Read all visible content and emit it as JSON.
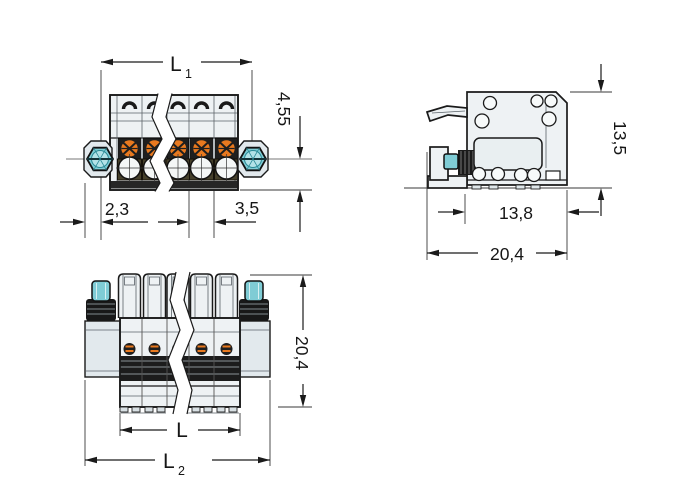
{
  "palette": {
    "line": "#1a1a1a",
    "body_fill": "#eef2f4",
    "shade_fill": "#e2e9ed",
    "screw_teal": "#7fccd5",
    "screw_teal_light": "#b2e2e7",
    "actuator_orange": "#e8791f",
    "dark_fill": "#1f1f1f",
    "contact_olive": "#45402b"
  },
  "views": {
    "front": {
      "dims": {
        "l1_main": "L",
        "l1_sub": "1",
        "edge_height": "4,55",
        "flange_offset": "2,3",
        "pole_pitch": "3,5"
      }
    },
    "side": {
      "dims": {
        "height": "13,5",
        "depth": "13,8",
        "total_depth": "20,4"
      }
    },
    "top": {
      "dims": {
        "total_height": "20,4",
        "l_main": "L",
        "l2_main": "L",
        "l2_sub": "2"
      }
    }
  }
}
